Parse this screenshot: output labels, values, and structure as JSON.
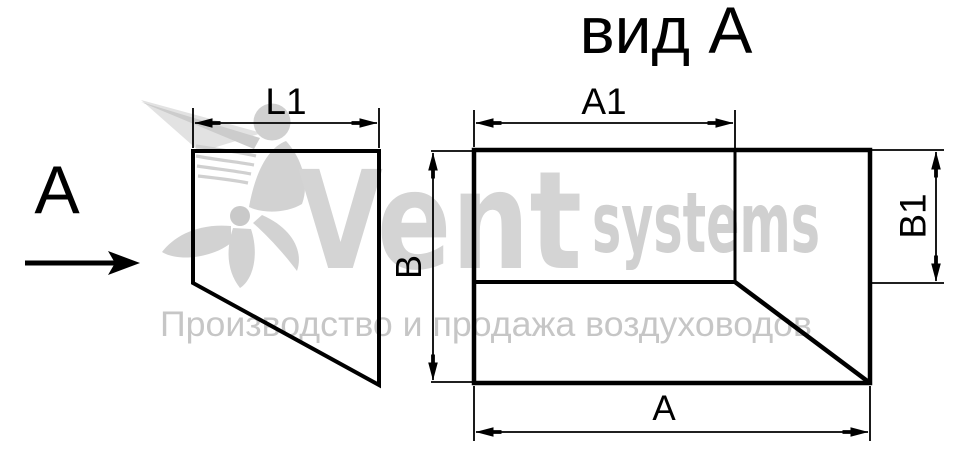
{
  "drawing": {
    "title": "вид А",
    "view_arrow_label": "А",
    "dimension_labels": {
      "l1": "L1",
      "a1": "А1",
      "a": "А",
      "b": "В",
      "b1": "В1"
    }
  },
  "watermark": {
    "brand_main": "Vent",
    "brand_suffix": "systems",
    "tagline": "Производство и продажа воздуховодов"
  },
  "colors": {
    "line": "#000000",
    "watermark_gray": "#d2d2d2",
    "tagline_gray": "#c6c6c6"
  }
}
